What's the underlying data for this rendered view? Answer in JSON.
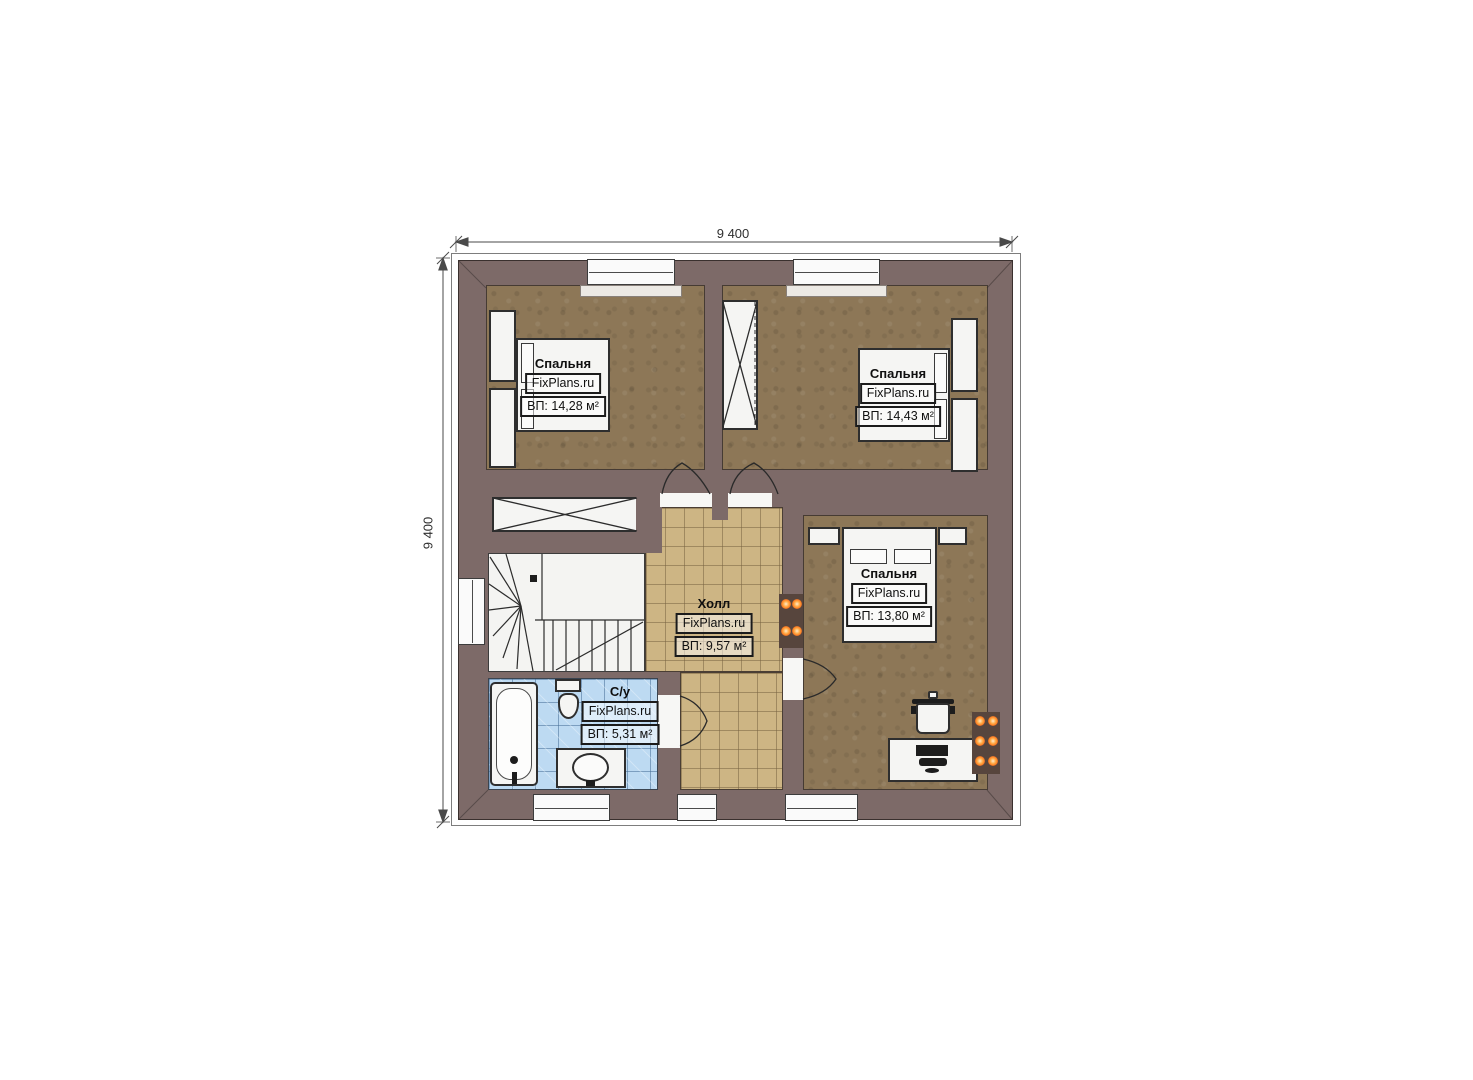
{
  "page": {
    "type": "architectural floor plan, second storey"
  },
  "dimensions": {
    "top": "9 400",
    "left": "9 400"
  },
  "rooms": [
    {
      "id": "bedroom-top-left",
      "name": "Спальня",
      "brand": "FixPlans.ru",
      "area": "ВП: 14,28 м²"
    },
    {
      "id": "bedroom-top-right",
      "name": "Спальня",
      "brand": "FixPlans.ru",
      "area": "ВП: 14,43 м²"
    },
    {
      "id": "bedroom-right",
      "name": "Спальня",
      "brand": "FixPlans.ru",
      "area": "ВП: 13,80 м²"
    },
    {
      "id": "hall",
      "name": "Холл",
      "brand": "FixPlans.ru",
      "area": "ВП: 9,57 м²"
    },
    {
      "id": "bathroom",
      "name": "С/у",
      "brand": "FixPlans.ru",
      "area": "ВП: 5,31 м²"
    }
  ],
  "colors": {
    "wall": "#7d6a68",
    "bedroom_floor": "#8d7757",
    "hall_tile": "#cdb584",
    "bathroom_tile": "#bddaf2",
    "stair_fill": "#f4f4f2",
    "furniture_fill": "#f5f5f3",
    "radiator_glow": "#ff7f24",
    "linework": "#2e2e2e"
  }
}
